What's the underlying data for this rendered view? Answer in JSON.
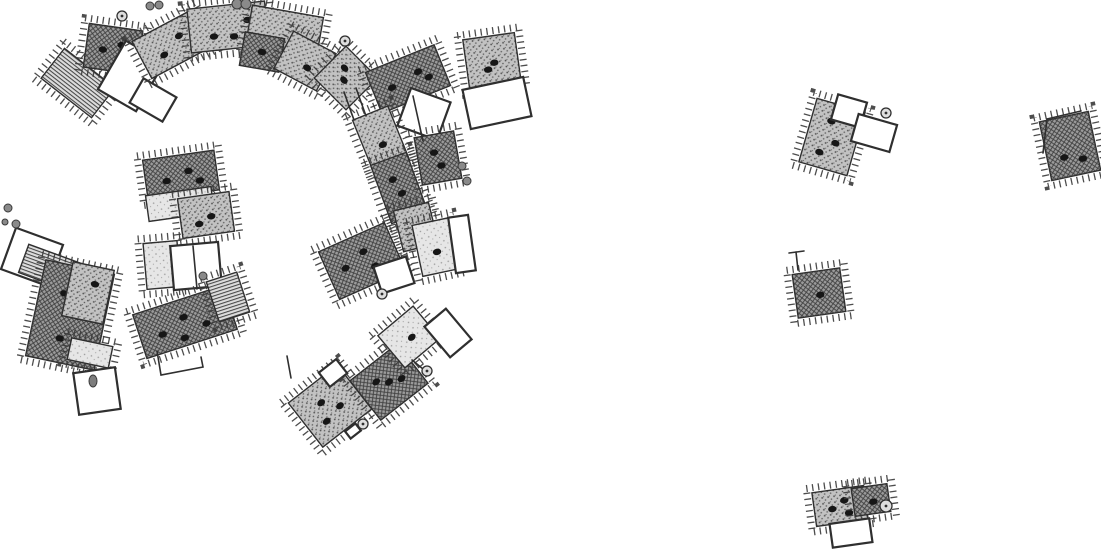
{
  "figure": {
    "kind": "archaeological-site-plan",
    "canvas": {
      "width": 1101,
      "height": 550
    },
    "background": "#ffffff"
  },
  "palette": {
    "ink": "#2f2f2f",
    "dark_fill_bg": "#9b9b9b",
    "dark_fill_line": "#3f3f3f",
    "medium_fill_bg": "#c2c2c2",
    "medium_fill_dot": "#4f4f4f",
    "light_fill_bg": "#e6e6e6",
    "light_fill_dot": "#9a9a9a",
    "ladder_fill_bg": "#dcdcdc",
    "ladder_fill_line": "#3f3f3f",
    "outline_fill": "#ffffff"
  },
  "buildings": [
    {
      "id": "arc-west-ladder",
      "cx": 78,
      "cy": 83,
      "w": 64,
      "h": 38,
      "rot": 38,
      "tone": "ladder",
      "ticks": true,
      "spots": []
    },
    {
      "id": "arc-west-hall",
      "cx": 113,
      "cy": 49,
      "w": 54,
      "h": 44,
      "rot": 8,
      "tone": "dark",
      "ticks": true,
      "spots": [
        [
          -10,
          2
        ],
        [
          8,
          -5
        ]
      ]
    },
    {
      "id": "arc-west-court",
      "cx": 131,
      "cy": 76,
      "w": 44,
      "h": 56,
      "rot": 30,
      "tone": "outline",
      "ticks": false,
      "spots": []
    },
    {
      "id": "arc-west-annex",
      "cx": 153,
      "cy": 100,
      "w": 38,
      "h": 28,
      "rot": 30,
      "tone": "outline",
      "ticks": false,
      "spots": []
    },
    {
      "id": "arc-band-1",
      "cx": 172,
      "cy": 44,
      "w": 68,
      "h": 42,
      "rot": -28,
      "tone": "medium",
      "ticks": true,
      "spots": [
        [
          -12,
          6
        ],
        [
          10,
          -4
        ]
      ]
    },
    {
      "id": "arc-band-2",
      "cx": 228,
      "cy": 27,
      "w": 78,
      "h": 44,
      "rot": -6,
      "tone": "medium",
      "ticks": true,
      "spots": [
        [
          -15,
          8
        ],
        [
          5,
          10
        ],
        [
          20,
          -5
        ]
      ]
    },
    {
      "id": "arc-band-3",
      "cx": 284,
      "cy": 34,
      "w": 72,
      "h": 46,
      "rot": 10,
      "tone": "medium",
      "ticks": true,
      "spots": [
        [
          -10,
          8
        ],
        [
          12,
          2
        ]
      ]
    },
    {
      "id": "arc-band-south",
      "cx": 262,
      "cy": 52,
      "w": 40,
      "h": 34,
      "rot": 10,
      "tone": "dark",
      "ticks": false,
      "spots": [
        [
          0,
          0
        ]
      ]
    },
    {
      "id": "arc-band-4",
      "cx": 305,
      "cy": 61,
      "w": 48,
      "h": 42,
      "rot": 28,
      "tone": "medium",
      "ticks": true,
      "spots": [
        [
          5,
          5
        ]
      ]
    },
    {
      "id": "house-diamond",
      "cx": 346,
      "cy": 78,
      "w": 45,
      "h": 45,
      "rot": 45,
      "tone": "medium",
      "ticks": true,
      "spots": [
        [
          0,
          3
        ],
        [
          -8,
          -6
        ]
      ]
    },
    {
      "id": "house-north-pair",
      "cx": 408,
      "cy": 79,
      "w": 74,
      "h": 44,
      "rot": -22,
      "tone": "dark",
      "ticks": true,
      "spots": [
        [
          -18,
          2
        ],
        [
          12,
          -3
        ],
        [
          20,
          6
        ]
      ]
    },
    {
      "id": "compound-court",
      "cx": 424,
      "cy": 114,
      "w": 42,
      "h": 40,
      "rot": 20,
      "tone": "outline",
      "ticks": false,
      "spots": []
    },
    {
      "id": "house-east-sq",
      "cx": 492,
      "cy": 61,
      "w": 52,
      "h": 50,
      "rot": -8,
      "tone": "medium",
      "ticks": true,
      "spots": [
        [
          2,
          2
        ],
        [
          -5,
          8
        ]
      ]
    },
    {
      "id": "court-east",
      "cx": 497,
      "cy": 103,
      "w": 62,
      "h": 40,
      "rot": -12,
      "tone": "outline",
      "ticks": false,
      "spots": []
    },
    {
      "id": "band-upper",
      "cx": 381,
      "cy": 140,
      "w": 38,
      "h": 58,
      "rot": -22,
      "tone": "medium",
      "ticks": true,
      "spots": [
        [
          0,
          5
        ]
      ]
    },
    {
      "id": "band-mid",
      "cx": 399,
      "cy": 188,
      "w": 38,
      "h": 62,
      "rot": -20,
      "tone": "dark",
      "ticks": true,
      "spots": [
        [
          1,
          6
        ],
        [
          -3,
          -10
        ]
      ]
    },
    {
      "id": "band-lower",
      "cx": 416,
      "cy": 227,
      "w": 36,
      "h": 42,
      "rot": -14,
      "tone": "medium",
      "ticks": true,
      "spots": []
    },
    {
      "id": "house-f",
      "cx": 438,
      "cy": 158,
      "w": 40,
      "h": 48,
      "rot": -10,
      "tone": "dark",
      "ticks": true,
      "spots": [
        [
          2,
          8
        ],
        [
          -3,
          -6
        ]
      ]
    },
    {
      "id": "g-north",
      "cx": 181,
      "cy": 175,
      "w": 72,
      "h": 40,
      "rot": -8,
      "tone": "dark",
      "ticks": true,
      "spots": [
        [
          -15,
          4
        ],
        [
          8,
          -3
        ],
        [
          18,
          8
        ]
      ]
    },
    {
      "id": "g-band-light",
      "cx": 180,
      "cy": 204,
      "w": 66,
      "h": 26,
      "rot": -8,
      "tone": "light",
      "ticks": false,
      "spots": []
    },
    {
      "id": "g-south",
      "cx": 206,
      "cy": 215,
      "w": 52,
      "h": 40,
      "rot": -8,
      "tone": "medium",
      "ticks": true,
      "spots": [
        [
          5,
          2
        ],
        [
          -8,
          8
        ]
      ]
    },
    {
      "id": "h-light",
      "cx": 162,
      "cy": 265,
      "w": 34,
      "h": 46,
      "rot": -5,
      "tone": "light",
      "ticks": true,
      "spots": []
    },
    {
      "id": "h-court",
      "cx": 196,
      "cy": 266,
      "w": 48,
      "h": 44,
      "rot": -5,
      "tone": "outline",
      "ticks": false,
      "spots": []
    },
    {
      "id": "i-annex-court",
      "cx": 32,
      "cy": 257,
      "w": 50,
      "h": 44,
      "rot": 20,
      "tone": "outline",
      "ticks": false,
      "spots": []
    },
    {
      "id": "i-ladder",
      "cx": 50,
      "cy": 268,
      "w": 56,
      "h": 30,
      "rot": 20,
      "tone": "ladder",
      "ticks": false,
      "spots": []
    },
    {
      "id": "i-main",
      "cx": 70,
      "cy": 315,
      "w": 70,
      "h": 98,
      "rot": 12,
      "tone": "dark",
      "ticks": true,
      "spots": [
        [
          -10,
          -20
        ],
        [
          8,
          0
        ],
        [
          -5,
          25
        ],
        [
          15,
          30
        ]
      ]
    },
    {
      "id": "i-east-wing",
      "cx": 88,
      "cy": 293,
      "w": 42,
      "h": 55,
      "rot": 12,
      "tone": "medium",
      "ticks": false,
      "spots": [
        [
          5,
          -10
        ]
      ]
    },
    {
      "id": "i-light-band",
      "cx": 90,
      "cy": 353,
      "w": 42,
      "h": 22,
      "rot": 12,
      "tone": "light",
      "ticks": true,
      "spots": []
    },
    {
      "id": "i-south-court",
      "cx": 97,
      "cy": 391,
      "w": 42,
      "h": 42,
      "rot": -8,
      "tone": "outline",
      "ticks": false,
      "spots": []
    },
    {
      "id": "j-hall",
      "cx": 185,
      "cy": 322,
      "w": 95,
      "h": 46,
      "rot": -18,
      "tone": "dark",
      "ticks": true,
      "spots": [
        [
          -25,
          5
        ],
        [
          0,
          -5
        ],
        [
          20,
          8
        ],
        [
          -5,
          15
        ]
      ]
    },
    {
      "id": "j-ladder-end",
      "cx": 228,
      "cy": 297,
      "w": 32,
      "h": 42,
      "rot": -18,
      "tone": "ladder",
      "ticks": true,
      "spots": []
    },
    {
      "id": "l-west",
      "cx": 330,
      "cy": 406,
      "w": 62,
      "h": 56,
      "rot": -38,
      "tone": "medium",
      "ticks": true,
      "spots": [
        [
          -5,
          -8
        ],
        [
          8,
          6
        ],
        [
          -12,
          10
        ]
      ]
    },
    {
      "id": "l-west-notch",
      "cx": 333,
      "cy": 373,
      "w": 22,
      "h": 18,
      "rot": -38,
      "tone": "outline",
      "ticks": false,
      "spots": []
    },
    {
      "id": "l-east",
      "cx": 389,
      "cy": 382,
      "w": 60,
      "h": 50,
      "rot": -38,
      "tone": "dark",
      "ticks": true,
      "spots": [
        [
          0,
          0
        ],
        [
          -10,
          -8
        ],
        [
          12,
          5
        ]
      ]
    },
    {
      "id": "l-tiny-annex",
      "cx": 353,
      "cy": 431,
      "w": 13,
      "h": 9,
      "rot": -38,
      "tone": "outline",
      "ticks": false,
      "spots": []
    },
    {
      "id": "m-light",
      "cx": 409,
      "cy": 337,
      "w": 46,
      "h": 42,
      "rot": -40,
      "tone": "light",
      "ticks": true,
      "spots": [
        [
          2,
          2
        ]
      ]
    },
    {
      "id": "m-court",
      "cx": 448,
      "cy": 333,
      "w": 28,
      "h": 40,
      "rot": -40,
      "tone": "outline",
      "ticks": false,
      "spots": []
    },
    {
      "id": "n-hall",
      "cx": 362,
      "cy": 261,
      "w": 72,
      "h": 52,
      "rot": -24,
      "tone": "dark",
      "ticks": true,
      "spots": [
        [
          -18,
          0
        ],
        [
          5,
          -8
        ],
        [
          10,
          10
        ]
      ]
    },
    {
      "id": "n-court",
      "cx": 394,
      "cy": 275,
      "w": 34,
      "h": 28,
      "rot": -18,
      "tone": "outline",
      "ticks": false,
      "spots": []
    },
    {
      "id": "n-light",
      "cx": 436,
      "cy": 247,
      "w": 38,
      "h": 52,
      "rot": -12,
      "tone": "light",
      "ticks": true,
      "spots": [
        [
          0,
          5
        ]
      ]
    },
    {
      "id": "n-fan-court",
      "cx": 462,
      "cy": 244,
      "w": 20,
      "h": 56,
      "rot": -8,
      "tone": "outline",
      "ticks": false,
      "spots": []
    },
    {
      "id": "r1-house",
      "cx": 832,
      "cy": 137,
      "w": 50,
      "h": 66,
      "rot": 16,
      "tone": "medium",
      "ticks": true,
      "spots": [
        [
          -5,
          -15
        ],
        [
          5,
          5
        ],
        [
          -8,
          18
        ]
      ]
    },
    {
      "id": "r1-court-north",
      "cx": 849,
      "cy": 111,
      "w": 30,
      "h": 26,
      "rot": 16,
      "tone": "outline",
      "ticks": false,
      "spots": []
    },
    {
      "id": "r1-court-east",
      "cx": 874,
      "cy": 133,
      "w": 40,
      "h": 28,
      "rot": 16,
      "tone": "outline",
      "ticks": false,
      "spots": []
    },
    {
      "id": "r2-house",
      "cx": 1070,
      "cy": 146,
      "w": 50,
      "h": 60,
      "rot": -12,
      "tone": "dark",
      "ticks": true,
      "spots": [
        [
          -8,
          10
        ],
        [
          10,
          15
        ]
      ]
    },
    {
      "id": "r3-house",
      "cx": 819,
      "cy": 293,
      "w": 48,
      "h": 44,
      "rot": -8,
      "tone": "dark",
      "ticks": true,
      "spots": [
        [
          1,
          2
        ]
      ]
    },
    {
      "id": "r4-west",
      "cx": 840,
      "cy": 506,
      "w": 52,
      "h": 34,
      "rot": -8,
      "tone": "medium",
      "ticks": true,
      "spots": [
        [
          -8,
          2
        ],
        [
          5,
          -5
        ],
        [
          8,
          8
        ]
      ]
    },
    {
      "id": "r4-east",
      "cx": 871,
      "cy": 500,
      "w": 36,
      "h": 28,
      "rot": -8,
      "tone": "dark",
      "ticks": true,
      "spots": [
        [
          2,
          2
        ]
      ]
    },
    {
      "id": "r4-court",
      "cx": 851,
      "cy": 533,
      "w": 40,
      "h": 24,
      "rot": -8,
      "tone": "outline",
      "ticks": false,
      "spots": []
    }
  ],
  "lines": [
    {
      "id": "connector-a",
      "pts": [
        [
          344,
          92
        ],
        [
          354,
          120
        ]
      ]
    },
    {
      "id": "connector-b",
      "pts": [
        [
          356,
          88
        ],
        [
          366,
          116
        ]
      ]
    },
    {
      "id": "compound-divider",
      "pts": [
        [
          413,
          96
        ],
        [
          423,
          141
        ]
      ]
    },
    {
      "id": "h-court-divider",
      "pts": [
        [
          193,
          246
        ],
        [
          197,
          289
        ]
      ]
    },
    {
      "id": "j-annex-wall",
      "pts": [
        [
          157,
          351
        ],
        [
          161,
          375
        ],
        [
          203,
          367
        ],
        [
          201,
          357
        ]
      ]
    },
    {
      "id": "l-west-wall",
      "pts": [
        [
          287,
          356
        ],
        [
          291,
          378
        ]
      ]
    },
    {
      "id": "l-east-marker-tie",
      "pts": [
        [
          412,
          360
        ],
        [
          423,
          369
        ]
      ]
    },
    {
      "id": "r3-corner-a",
      "pts": [
        [
          796,
          252
        ],
        [
          798,
          270
        ]
      ]
    },
    {
      "id": "r3-corner-b",
      "pts": [
        [
          789,
          253
        ],
        [
          804,
          251
        ]
      ]
    },
    {
      "id": "r2-open-wall-a",
      "pts": [
        [
          1047,
          119
        ],
        [
          1043,
          153
        ]
      ]
    },
    {
      "id": "r2-open-wall-b",
      "pts": [
        [
          1047,
          119
        ],
        [
          1081,
          111
        ]
      ]
    }
  ],
  "markers": [
    {
      "id": "stone-ring-nw",
      "type": "circle",
      "x": 122,
      "y": 16,
      "r": 5
    },
    {
      "id": "stone-pair-nw-a",
      "type": "blob",
      "x": 150,
      "y": 6,
      "r": 4
    },
    {
      "id": "stone-pair-nw-b",
      "type": "blob",
      "x": 159,
      "y": 5,
      "r": 4
    },
    {
      "id": "stone-pair-n-a",
      "type": "blob",
      "x": 237,
      "y": 4,
      "r": 5
    },
    {
      "id": "stone-pair-n-b",
      "type": "blob",
      "x": 246,
      "y": 4,
      "r": 5
    },
    {
      "id": "stone-ring-nc",
      "type": "circle",
      "x": 345,
      "y": 41,
      "r": 5
    },
    {
      "id": "stone-w-a",
      "type": "blob",
      "x": 8,
      "y": 208,
      "r": 4
    },
    {
      "id": "stone-w-b",
      "type": "blob",
      "x": 5,
      "y": 222,
      "r": 3
    },
    {
      "id": "stone-w-c",
      "type": "blob",
      "x": 16,
      "y": 224,
      "r": 4
    },
    {
      "id": "stone-e-a",
      "type": "blob",
      "x": 462,
      "y": 166,
      "r": 4
    },
    {
      "id": "stone-e-b",
      "type": "blob",
      "x": 467,
      "y": 181,
      "r": 4
    },
    {
      "id": "stone-center",
      "type": "blob",
      "x": 203,
      "y": 276,
      "r": 4
    },
    {
      "id": "point-n-hall",
      "type": "circle",
      "x": 382,
      "y": 294,
      "r": 5
    },
    {
      "id": "point-l-west",
      "type": "circle",
      "x": 363,
      "y": 424,
      "r": 5
    },
    {
      "id": "point-l-east",
      "type": "circle",
      "x": 427,
      "y": 371,
      "r": 5
    },
    {
      "id": "point-r1",
      "type": "circle",
      "x": 886,
      "y": 113,
      "r": 5
    },
    {
      "id": "point-r4",
      "type": "circle",
      "x": 886,
      "y": 506,
      "r": 6
    },
    {
      "id": "stone-i-court",
      "type": "stone",
      "x": 93,
      "y": 381,
      "rx": 4,
      "ry": 6
    }
  ]
}
